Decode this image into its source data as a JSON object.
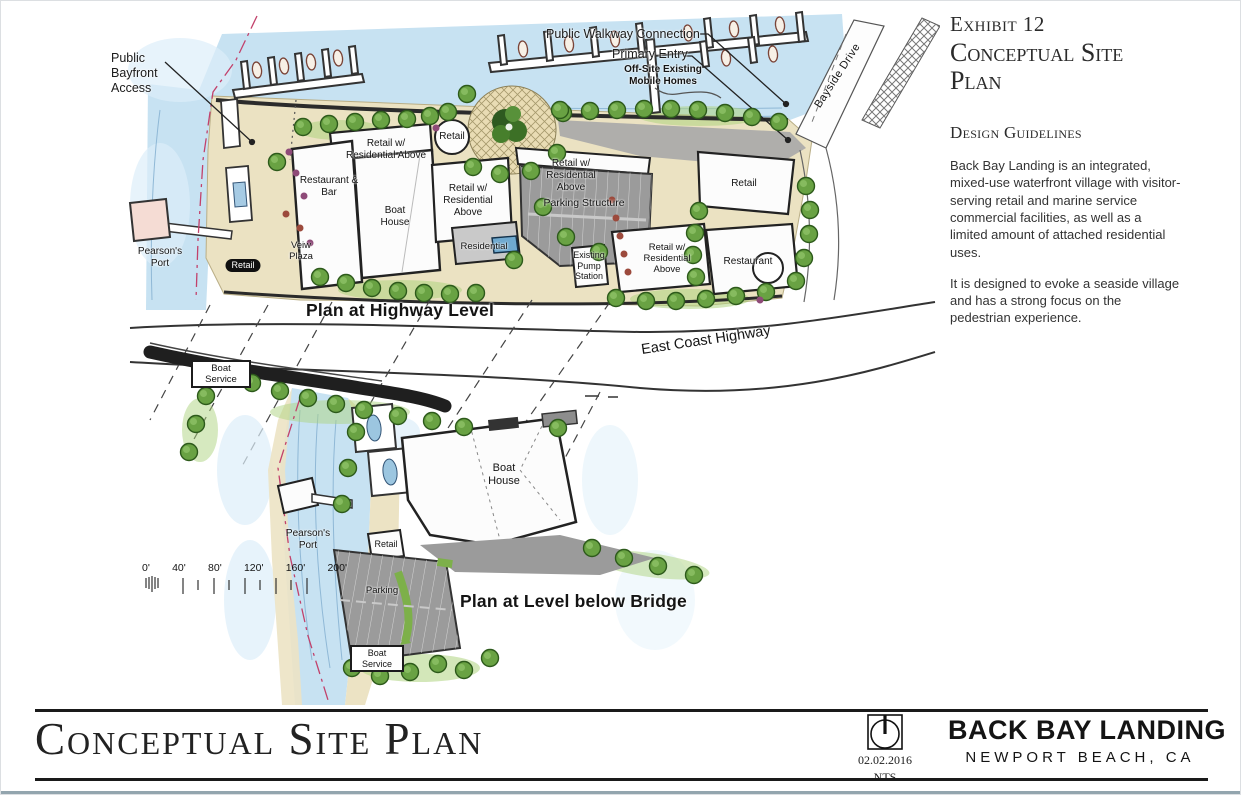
{
  "side_panel": {
    "exhibit": "Exhibit 12",
    "title": "Conceptual Site Plan",
    "heading": "Design Guidelines",
    "para1": "Back Bay Landing is an integrated, mixed-use waterfront village with visitor- serving retail and marine service commercial facilities, as well as a limited amount of attached residential uses.",
    "para2": "It is designed to evoke a seaside village and has a strong focus on the pedestrian experience."
  },
  "map": {
    "upper": {
      "plan_title": "Plan at Highway Level",
      "highway_label": "East Coast Highway",
      "bayside_drive_label": "Bayside Drive",
      "callouts": {
        "bayfront": "Public Bayfront Access",
        "walkway": "Public Walkway Connection",
        "entry": "Primary Entry",
        "mobile_homes": "Off-Site Existing Mobile Homes"
      },
      "labels": {
        "retail_res_nw": "Retail w/ Residential Above",
        "retail_kiosk": "Retail",
        "restaurant_bar": "Restaurant & Bar",
        "boat_house": "Boat House",
        "retail_res_mid": "Retail w/ Residential Above",
        "residential": "Residential",
        "parking_structure": "Parking Structure",
        "retail_res_parking": "Retail w/ Residential Above",
        "pump_station": "Existing Pump Station",
        "retail_res_east": "Retail w/ Residential Above",
        "retail_east": "Retail",
        "restaurant_east": "Restaurant",
        "pearsons_port": "Pearson's Port",
        "retail_west": "Retail",
        "view_plaza": "Veiw Plaza"
      }
    },
    "lower": {
      "plan_title": "Plan at Level below Bridge",
      "labels": {
        "boat_service_n": "Boat Service",
        "pearsons_port": "Pearson's Port",
        "boat_house": "Boat House",
        "retail": "Retail",
        "parking": "Parking",
        "boat_service_s": "Boat Service"
      },
      "scale_ticks": [
        "0'",
        "40'",
        "80'",
        "120'",
        "160'",
        "200'"
      ]
    }
  },
  "footer": {
    "sheet_title": "Conceptual Site Plan",
    "date": "02.02.2016",
    "scale_note": "NTS",
    "project": "BACK BAY LANDING",
    "location": "NEWPORT BEACH, CA"
  },
  "colors": {
    "water": "#c7e2f2",
    "sand": "#ebe2c2",
    "parking_gray": "#9b9b9b",
    "tree_green": "#69a243",
    "property_line_red": "#c2416b",
    "ink": "#1a1a1a"
  }
}
